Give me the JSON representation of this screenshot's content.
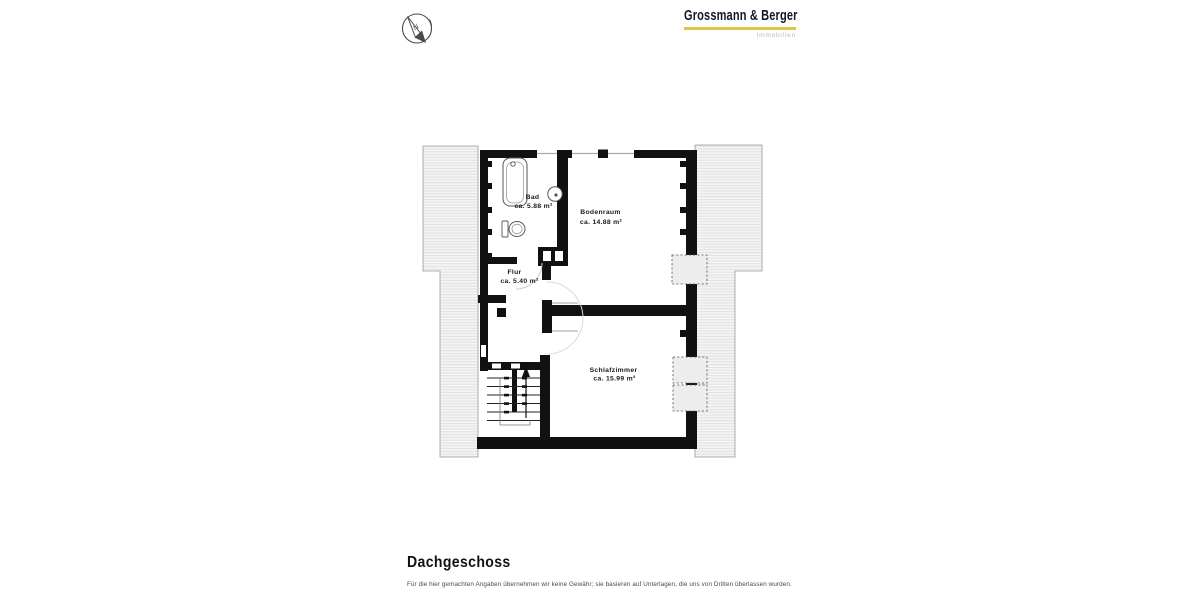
{
  "header": {
    "compass_icon": "north-arrow-compass",
    "logo": {
      "title": "Grossmann & Berger",
      "subtitle": "Immobilien",
      "underline_color": "#e2c445"
    }
  },
  "floor_plan": {
    "rooms": [
      {
        "name": "Bad",
        "area": "ca. 5.88 m²"
      },
      {
        "name": "Bodenraum",
        "area": "ca. 14.88 m²"
      },
      {
        "name": "Flur",
        "area": "ca. 5.40 m²"
      },
      {
        "name": "Schlafzimmer",
        "area": "ca. 15.99 m²"
      }
    ],
    "features": [
      "bathtub",
      "wash-basin",
      "toilet",
      "chimney",
      "staircase",
      "roof-overhang-left",
      "roof-overhang-right",
      "dormer-windows",
      "door-swings"
    ],
    "stair_direction": "up"
  },
  "footer": {
    "title": "Dachgeschoss",
    "disclaimer": "Für die hier gemachten Angaben übernehmen wir keine Gewähr; sie basieren auf Unterlagen, die uns von Dritten überlassen wurden."
  },
  "colors": {
    "wall": "#111111",
    "roof_hatch_bg": "#f5f5f5",
    "roof_hatch_line": "#dddddd",
    "accent": "#e2c445",
    "logo_text": "#15152b",
    "logo_subtitle": "#b9b9b9",
    "muted_text": "#4a4a4a"
  }
}
